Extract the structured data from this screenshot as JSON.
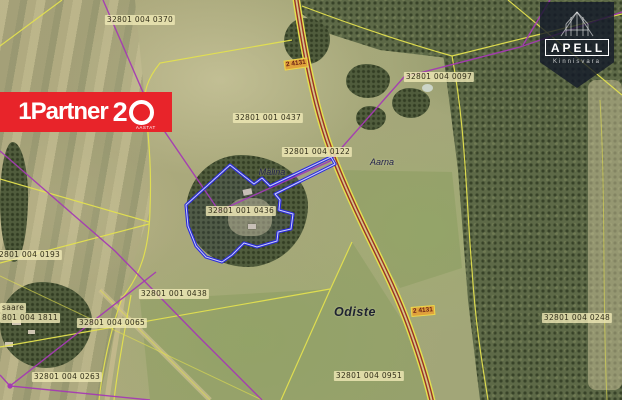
{
  "colors": {
    "cad-yellow": "#e3e04f",
    "net-purple": "#a43ab3",
    "road-red": "#9a3326",
    "parcel-blue": "#2b2bdc",
    "partner-red": "#e8242a"
  },
  "branding": {
    "partner": {
      "name": "1Partner",
      "number2": "2",
      "years": "AASTAT"
    },
    "apell": {
      "name": "APELL",
      "subtitle": "Kinnisvara"
    }
  },
  "map": {
    "subject_parcel_id": "32801 001 0436",
    "parcel_labels": [
      {
        "text": "32801 004 0370",
        "x": 140,
        "y": 20
      },
      {
        "text": "32801 004 0097",
        "x": 439,
        "y": 77
      },
      {
        "text": "32801 001 0437",
        "x": 268,
        "y": 118
      },
      {
        "text": "32801 004 0122",
        "x": 317,
        "y": 152
      },
      {
        "text": "32801 001 0436",
        "x": 241,
        "y": 211
      },
      {
        "text": "32801 004 0193",
        "x": 27,
        "y": 255
      },
      {
        "text": "32801 001 0438",
        "x": 174,
        "y": 294
      },
      {
        "text": "saare",
        "x": 0,
        "y": 308,
        "anchor": "left"
      },
      {
        "text": "801 004 1811",
        "x": 0,
        "y": 318,
        "anchor": "left"
      },
      {
        "text": "32801 004 0065",
        "x": 112,
        "y": 323
      },
      {
        "text": "32801 004 0263",
        "x": 67,
        "y": 377
      },
      {
        "text": "32801 004 0951",
        "x": 369,
        "y": 376
      },
      {
        "text": "32801 004 0248",
        "x": 577,
        "y": 318
      }
    ],
    "place_labels": [
      {
        "text": "Mälina",
        "x": 272,
        "y": 172
      },
      {
        "text": "Aarna",
        "x": 382,
        "y": 162
      },
      {
        "text": "Odiste",
        "x": 355,
        "y": 312,
        "emphasis": true
      }
    ],
    "road_labels": [
      {
        "text": "2 4131",
        "x": 296,
        "y": 64,
        "rot": -8
      },
      {
        "text": "2 4131",
        "x": 423,
        "y": 311,
        "rot": -5
      }
    ]
  }
}
